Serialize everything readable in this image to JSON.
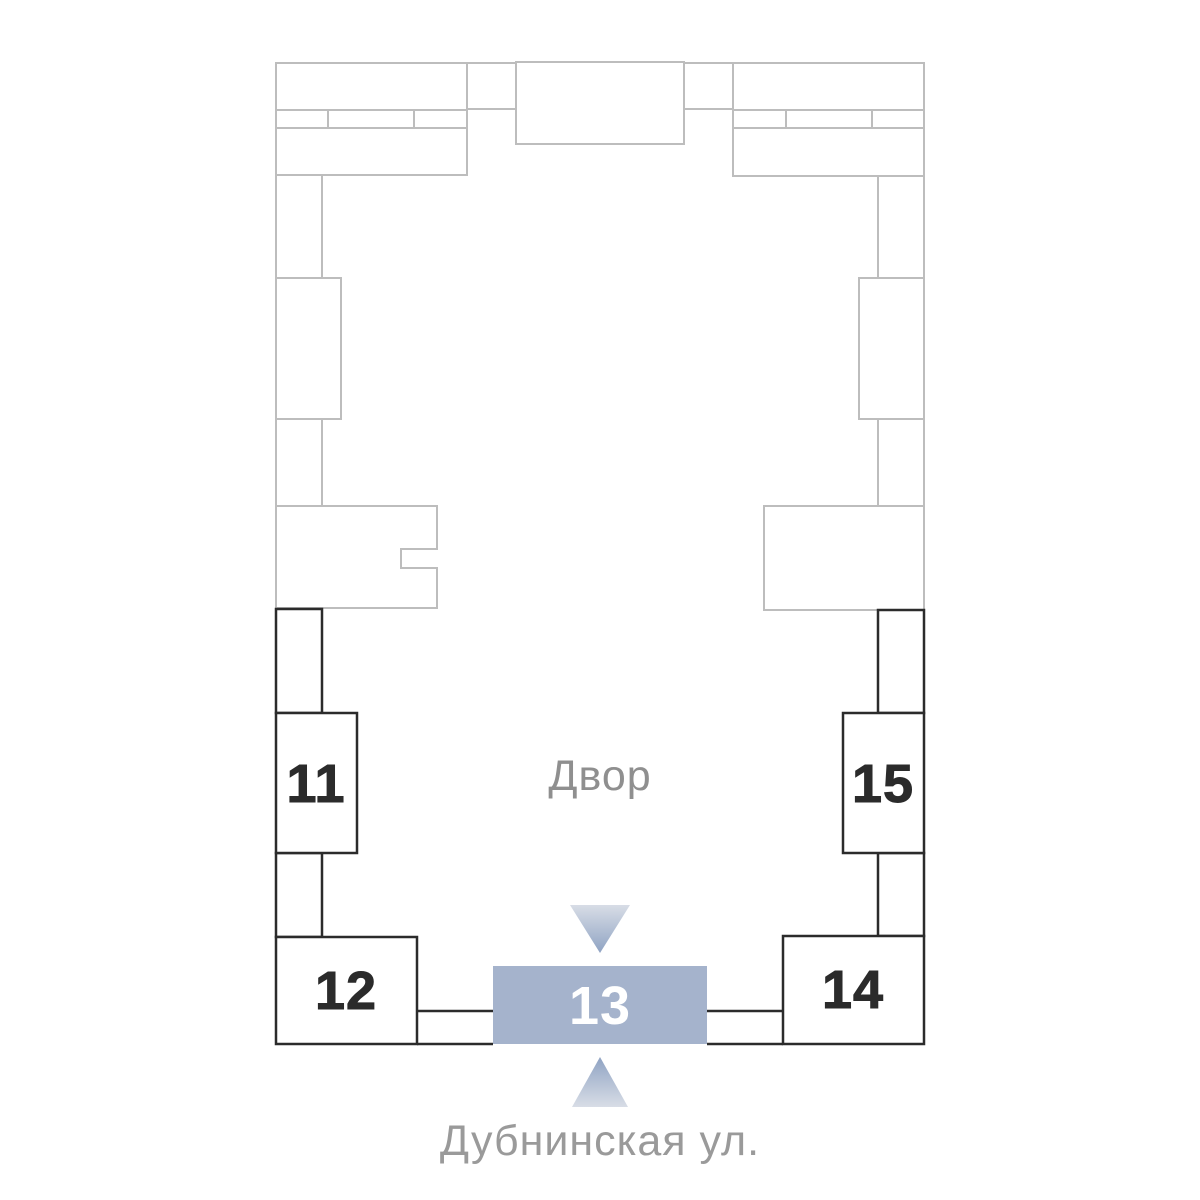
{
  "plan": {
    "courtyard_label": "Двор",
    "street_label": "Дубнинская ул.",
    "selected_building": "13",
    "buildings": [
      {
        "number": "11",
        "highlighted": false
      },
      {
        "number": "12",
        "highlighted": false
      },
      {
        "number": "13",
        "highlighted": true
      },
      {
        "number": "14",
        "highlighted": false
      },
      {
        "number": "15",
        "highlighted": false
      }
    ],
    "colors": {
      "highlight_fill": "#a5b3cc",
      "highlight_text": "#ffffff",
      "building_outline": "#2b2b2b",
      "context_outline": "#bdbdbd",
      "courtyard_label_color": "#8f8f8f",
      "street_label_color": "#9a9a9a",
      "arrow_tip": "#8fa3c3",
      "arrow_base": "#d8dde6"
    }
  }
}
